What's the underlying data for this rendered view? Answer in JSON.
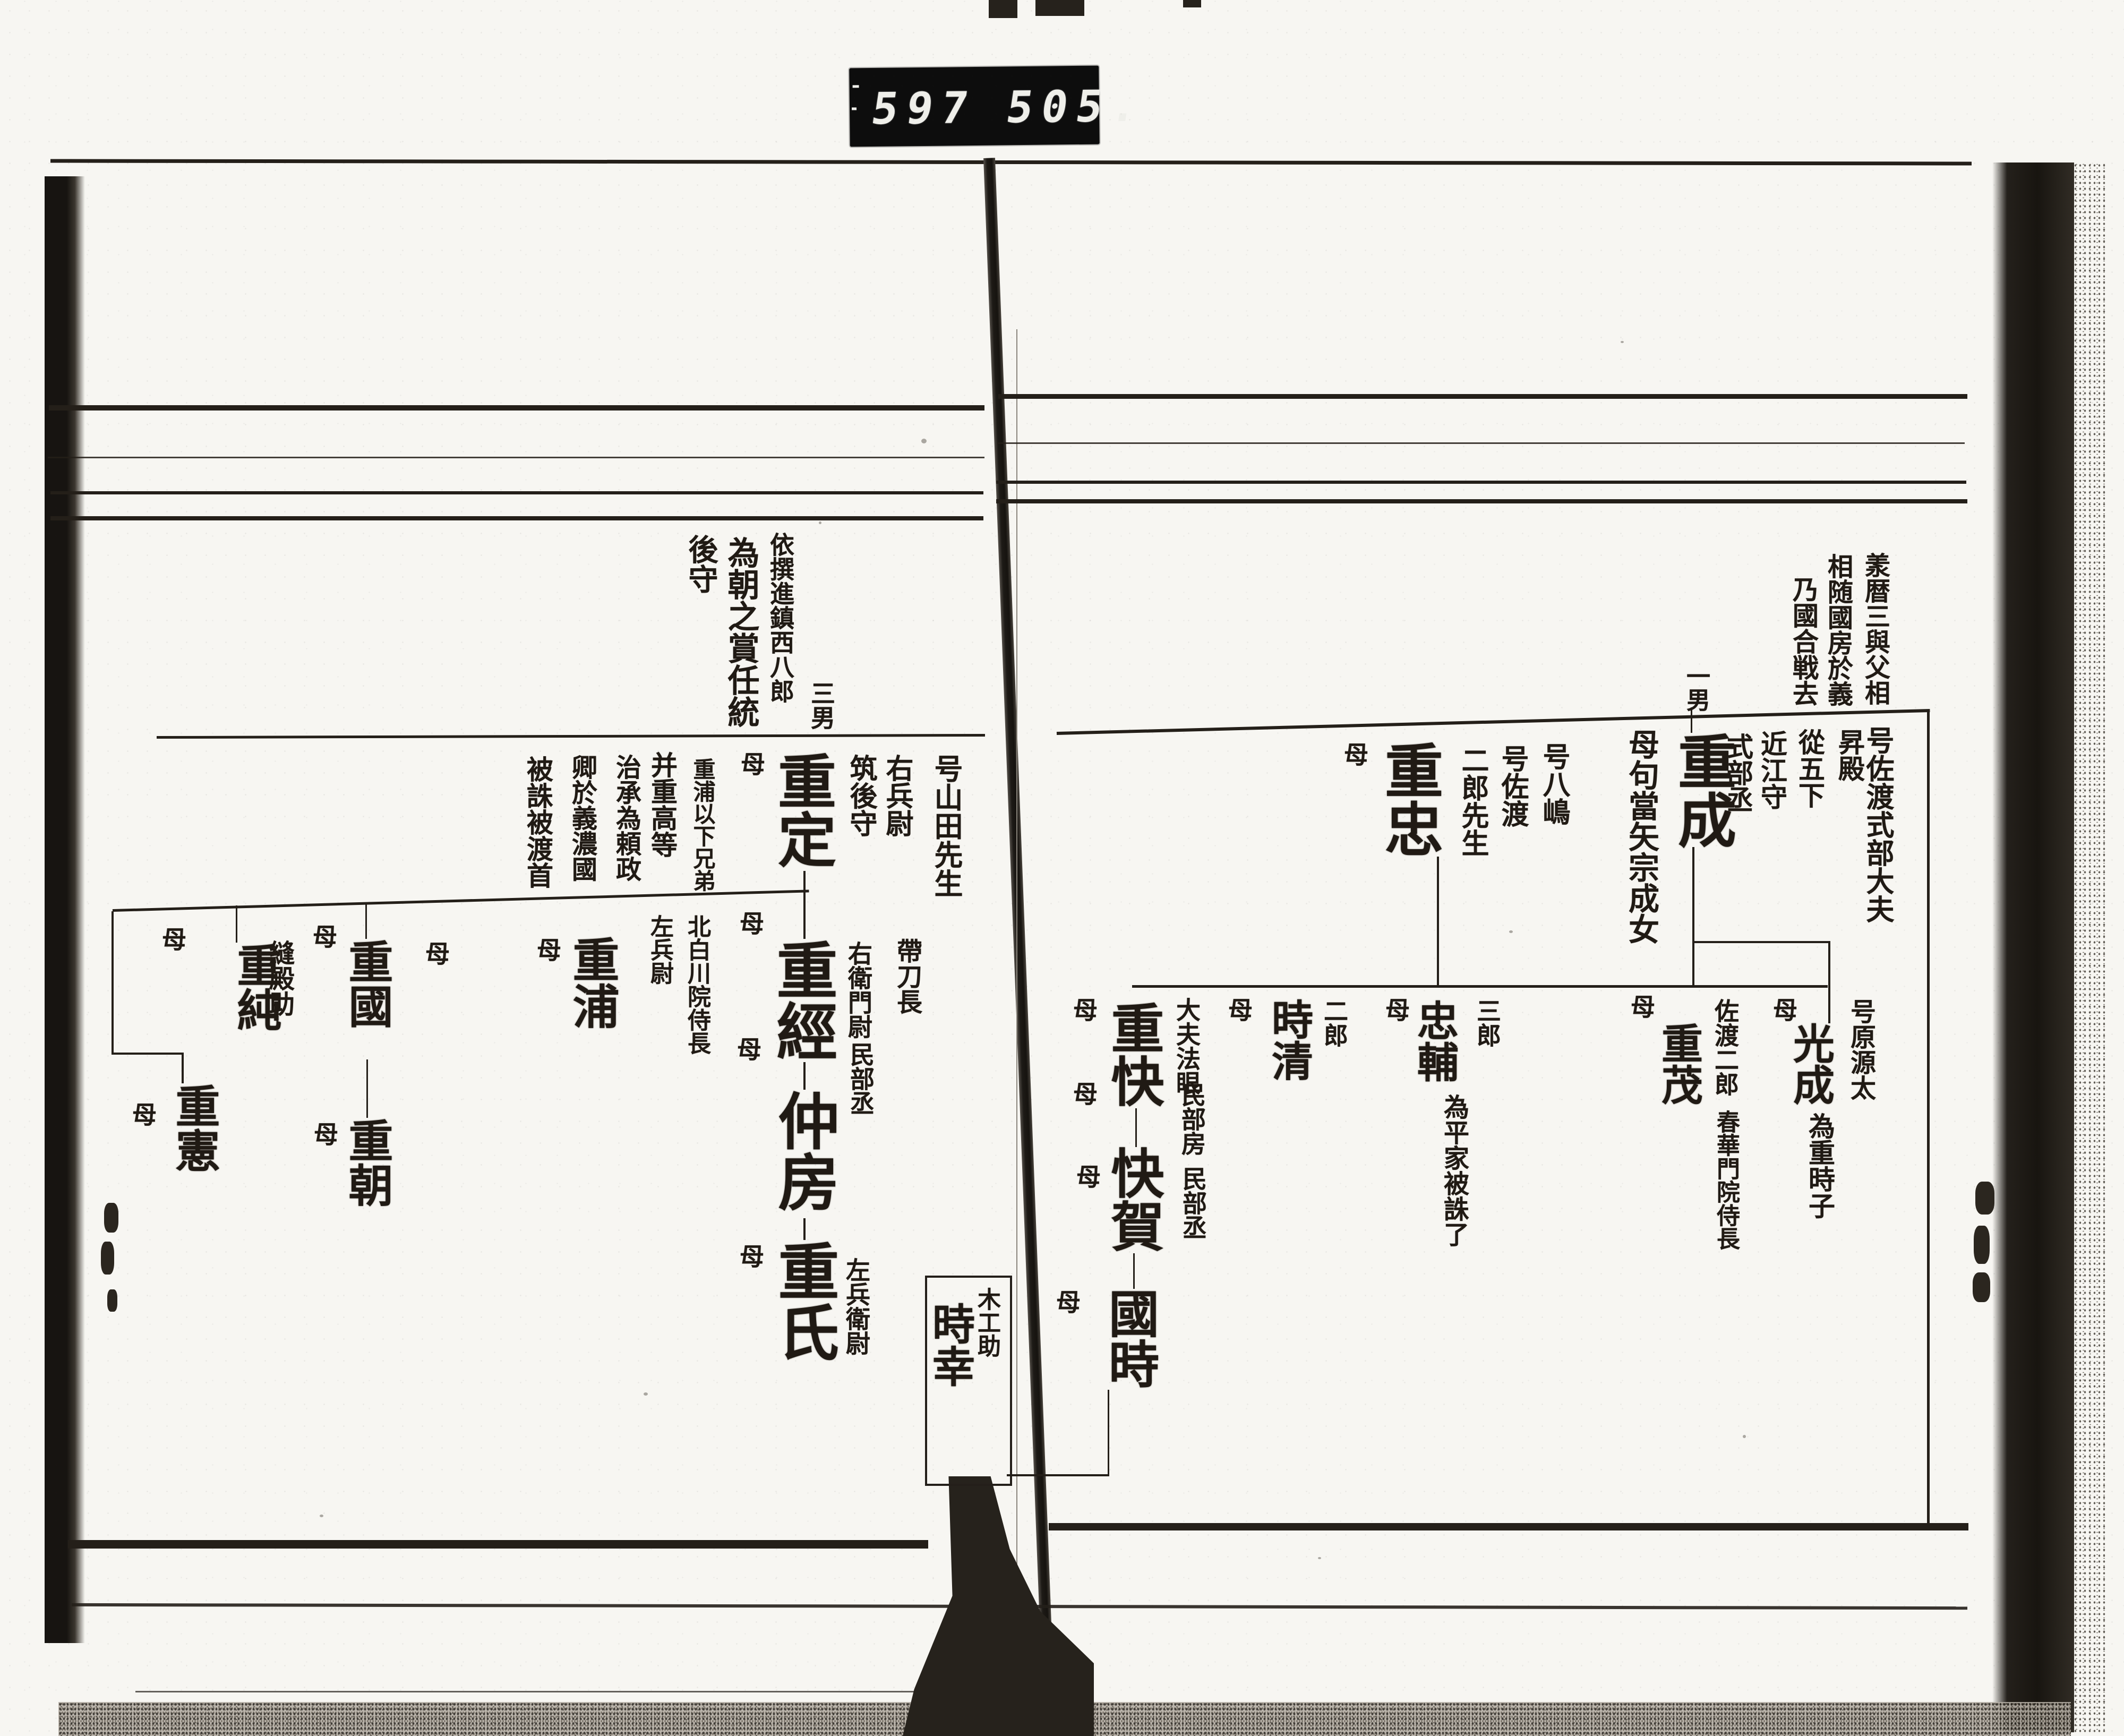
{
  "stamp": {
    "left_number": "597",
    "right_number": "505."
  },
  "right_page": {
    "note_block": {
      "col1": "羕暦三與父相",
      "col2": "相随國房於義",
      "col3": "乃國合戦去"
    },
    "father_titles": [
      "号佐渡式部大夫",
      "昇殿",
      "從五下",
      "近江守",
      "式部丞"
    ],
    "shigenari": {
      "rank": "一男",
      "name": "重成",
      "mother_note": "母句當矢宗成女"
    },
    "shigetada": {
      "alias1": "号八嶋",
      "alias2": "号佐渡",
      "rank": "二郎先生",
      "name": "重忠",
      "mother": "母"
    },
    "mitsunari": {
      "alias": "号原源太",
      "name": "光成",
      "note": "為重時子",
      "mother": "母"
    },
    "shigemochi": {
      "name": "重茂",
      "title1": "佐渡二郎",
      "title2": "春華門院侍長",
      "mother": "母"
    },
    "tadasuke": {
      "rank": "三郎",
      "name": "忠輔",
      "note": "為平家被誅了",
      "mother": "母"
    },
    "tokikiyo": {
      "rank": "二郎",
      "name": "時清",
      "mother": "母"
    },
    "shigeyoshi": {
      "name": "重快",
      "title": "大夫法眼",
      "mother": "母"
    },
    "kaiga": {
      "name": "快賀",
      "title": "民部房",
      "mother": "母"
    },
    "kunitoki": {
      "name": "國時",
      "title": "民部丞",
      "mother": "母",
      "mother2": "母"
    },
    "tokiyuki": {
      "title": "木工助",
      "name": "時幸"
    }
  },
  "left_page": {
    "note_block": {
      "col1": "依撰進鎮西八郎",
      "col2": "為朝之賞任統",
      "col3": "後守"
    },
    "shigesada": {
      "rank": "三男",
      "name": "重定",
      "alias": "号山田先生",
      "title1": "右兵尉",
      "title2": "筑後守",
      "mother": "母"
    },
    "executed_note": [
      "重浦以下兄弟",
      "并重高等",
      "治承為頼政",
      "卿於義濃國",
      "被誅被渡首"
    ],
    "shigetsune": {
      "name": "重經",
      "title1": "帶刀長",
      "title2": "右衛門尉",
      "mother": "母"
    },
    "nakafusa": {
      "name": "仲房",
      "title": "民部丞",
      "mother": "母"
    },
    "shigeuji": {
      "name": "重氏",
      "title": "左兵衛尉",
      "mother": "母"
    },
    "shigeura": {
      "name": "重浦",
      "title1": "北白川院侍長",
      "title2": "左兵尉",
      "mother": "母"
    },
    "shigekuni": {
      "name": "重國",
      "mother": "母",
      "mother2": "母"
    },
    "shigetomo": {
      "name": "重朝",
      "mother": "母"
    },
    "shigezumi": {
      "name": "重純",
      "title": "縫殿助",
      "mother": "母"
    },
    "shigenori": {
      "name": "重憲",
      "mother": "母"
    }
  }
}
